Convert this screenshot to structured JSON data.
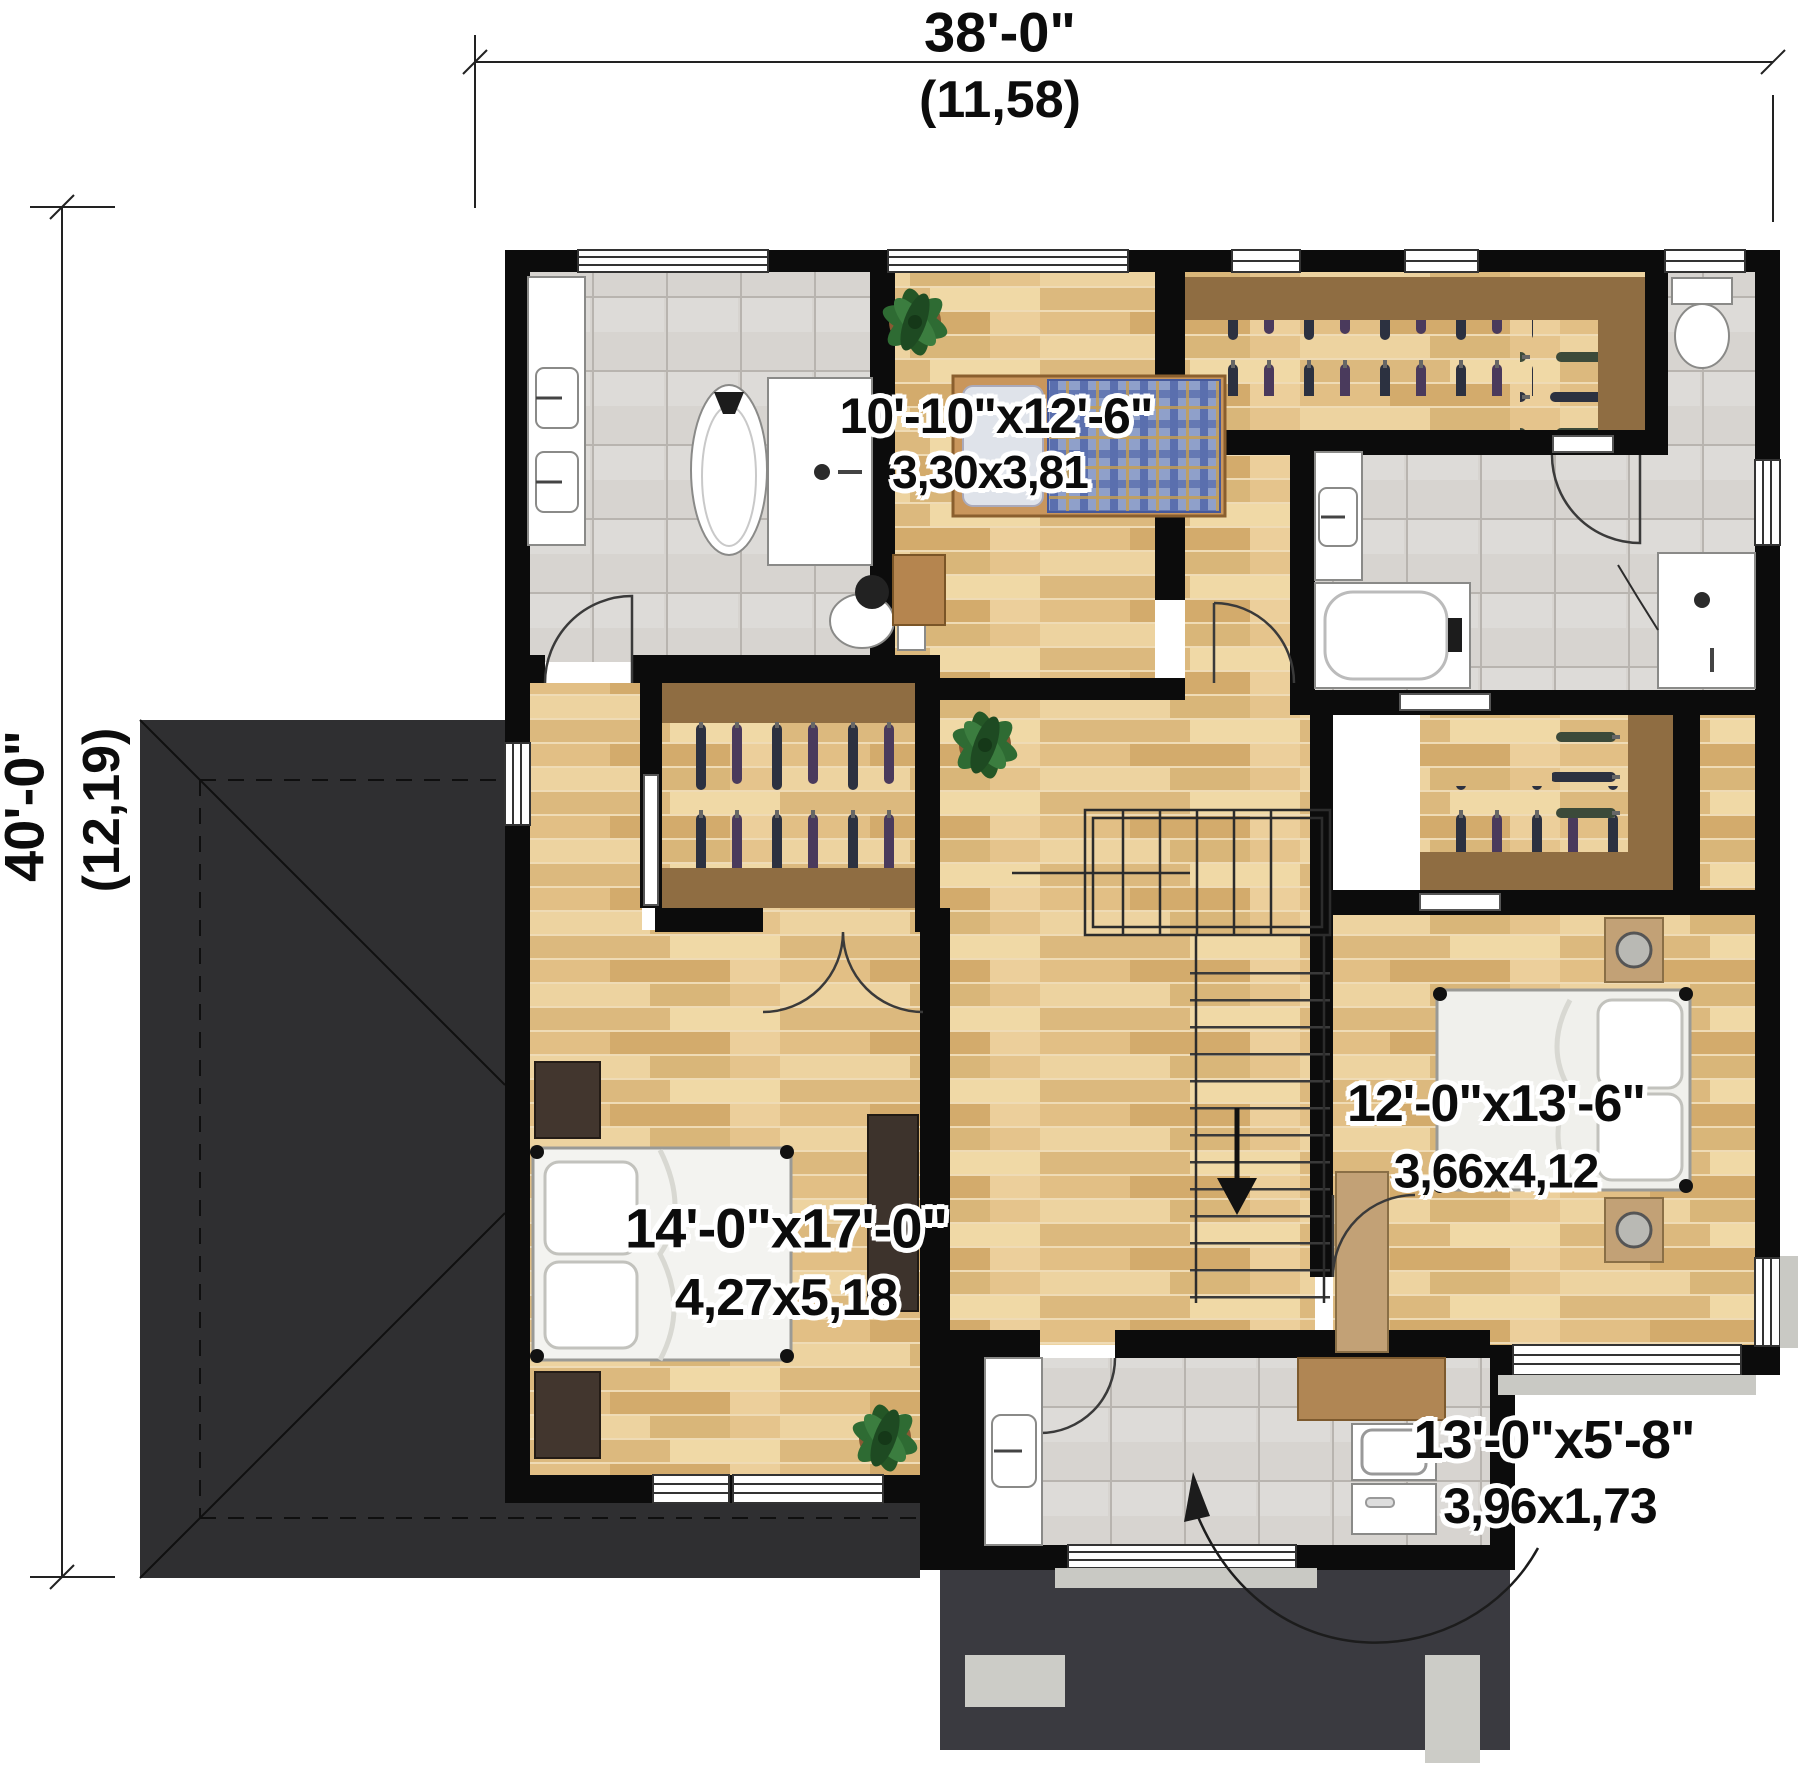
{
  "dimensions": {
    "overall_width": {
      "imperial": "38'-0\"",
      "metric": "(11,58)"
    },
    "overall_depth": {
      "imperial": "40'-0\"",
      "metric": "(12,19)"
    }
  },
  "rooms": [
    {
      "id": "bedroom-top",
      "imperial": "10'-10\"x12'-6\"",
      "metric": "3,30x3,81"
    },
    {
      "id": "bedroom-right",
      "imperial": "12'-0\"x13'-6\"",
      "metric": "3,66x4,12"
    },
    {
      "id": "master-bedroom",
      "imperial": "14'-0\"x17'-0\"",
      "metric": "4,27x5,18"
    },
    {
      "id": "laundry",
      "imperial": "13'-0\"x5'-8\"",
      "metric": "3,96x1,73"
    }
  ],
  "colors": {
    "wall": "#0c0c0c",
    "roof": "#2f2f31",
    "deck": "#3a3a40",
    "millwork": "#8f6d42",
    "wood_base": "#e7c78e",
    "tile_base": "#d7d4d0",
    "clothes": "#2c3140",
    "plant": "#2e6b33",
    "bed_plaid": "#8fa0ca",
    "furniture_dark": "#42362e",
    "furniture_tan": "#c2a176"
  }
}
